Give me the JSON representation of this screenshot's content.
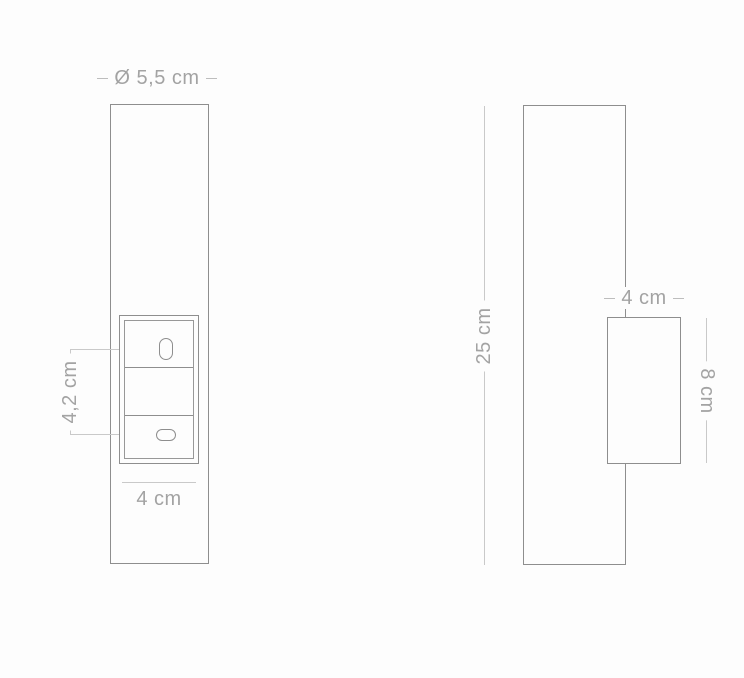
{
  "diagram": {
    "type": "product-dimension-drawing",
    "views": {
      "front_view": {
        "title": "front view",
        "diameter_label": "Ø 5,5 cm",
        "switch_height_label": "4,2 cm",
        "width_label": "4 cm"
      },
      "side_view": {
        "title": "side view",
        "height_label": "25 cm",
        "depth_label": "4 cm",
        "box_height_label": "8 cm"
      }
    },
    "colors": {
      "background": "#fdfdfd",
      "outline": "#8e8e8e",
      "dimension_line": "#c9c9c9",
      "label_text": "#a3a3a3"
    }
  }
}
